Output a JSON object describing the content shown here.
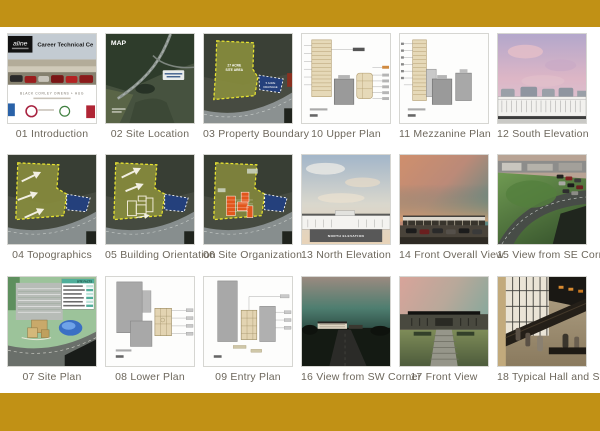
{
  "page": {
    "accent_color": "#c19115",
    "background_color": "#ffffff"
  },
  "gallery": {
    "items": [
      {
        "id": "01",
        "label": "01 Introduction"
      },
      {
        "id": "02",
        "label": "02 Site Location"
      },
      {
        "id": "03",
        "label": "03 Property Boundary"
      },
      {
        "id": "10",
        "label": "10 Upper Plan"
      },
      {
        "id": "11",
        "label": "11 Mezzanine Plan"
      },
      {
        "id": "12",
        "label": "12 South Elevation"
      },
      {
        "id": "04",
        "label": "04 Topographics"
      },
      {
        "id": "05",
        "label": "05 Building Orientation"
      },
      {
        "id": "06",
        "label": "06 Site Organization"
      },
      {
        "id": "13",
        "label": "13 North Elevation"
      },
      {
        "id": "14",
        "label": "14 Front Overall View"
      },
      {
        "id": "15",
        "label": "15 View from SE Corner"
      },
      {
        "id": "07",
        "label": "07 Site Plan"
      },
      {
        "id": "08",
        "label": "08 Lower Plan"
      },
      {
        "id": "09",
        "label": "09 Entry Plan"
      },
      {
        "id": "16",
        "label": "16 View from SW Corner"
      },
      {
        "id": "17",
        "label": "17 Front View"
      },
      {
        "id": "18",
        "label": "18 Typical Hall and Stair"
      }
    ]
  },
  "thumb_text": {
    "intro_brand": "aline",
    "intro_title": "Career Technical Ce",
    "intro_firm": "BLACK CORLEY OWENS + HUG",
    "map_label": "MAP",
    "site_area_line1": "27 ACRE",
    "site_area_line2": "SITE AREA",
    "drainage_line1": "5 ACRE",
    "drainage_line2": "DRAINAGE",
    "north_elevation_label": "NORTH ELEVATION",
    "site_facts_header": "SITE FACTS"
  }
}
